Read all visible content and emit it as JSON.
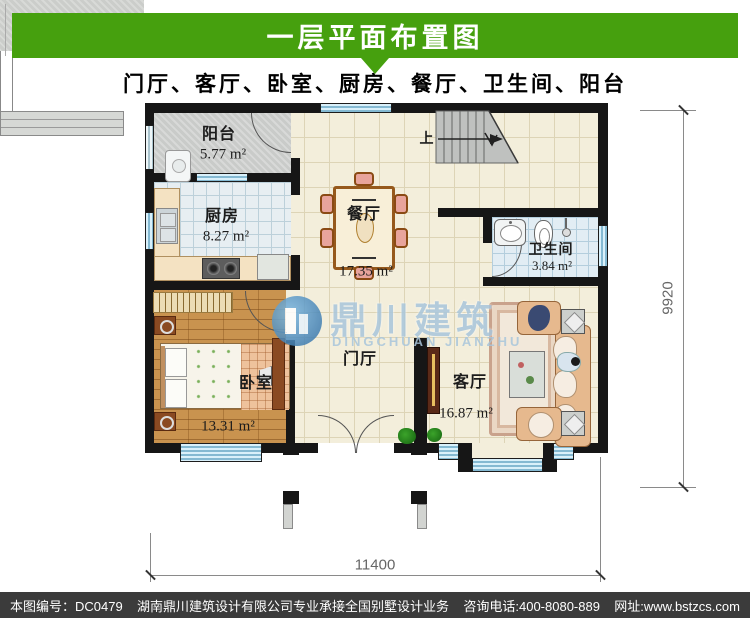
{
  "header": {
    "title": "一层平面布置图"
  },
  "subtitle": "门厅、客厅、卧室、厨房、餐厅、卫生间、阳台",
  "plan": {
    "rooms": {
      "balcony": {
        "label": "阳台",
        "area": "5.77 m²"
      },
      "kitchen": {
        "label": "厨房",
        "area": "8.27 m²"
      },
      "dining": {
        "label": "餐厅",
        "area": "17.35 m²"
      },
      "bathroom": {
        "label": "卫生间",
        "area": "3.84 m²"
      },
      "bedroom": {
        "label": "卧室",
        "area": "13.31 m²"
      },
      "hall": {
        "label": "门厅"
      },
      "living": {
        "label": "客厅",
        "area": "16.87 m²"
      }
    },
    "stairs": {
      "up_label": "上"
    },
    "dimensions": {
      "height_mm": "9920",
      "width_mm": "11400"
    }
  },
  "watermark": {
    "cn": "鼎川建筑",
    "en": "DINGCHUAN JIANZHU"
  },
  "footer": {
    "drawing_no": "本图编号：DC0479",
    "company": "湖南鼎川建筑设计有限公司专业承接全国别墅设计业务",
    "phone": "咨询电话:400-8080-889",
    "website": "网址:www.bstzcs.com"
  },
  "colors": {
    "header_green": "#46a00e",
    "footer_bg": "#3b3b3b",
    "watermark_blue": "#a9c6dc",
    "window_blue": "#84b9d2"
  }
}
